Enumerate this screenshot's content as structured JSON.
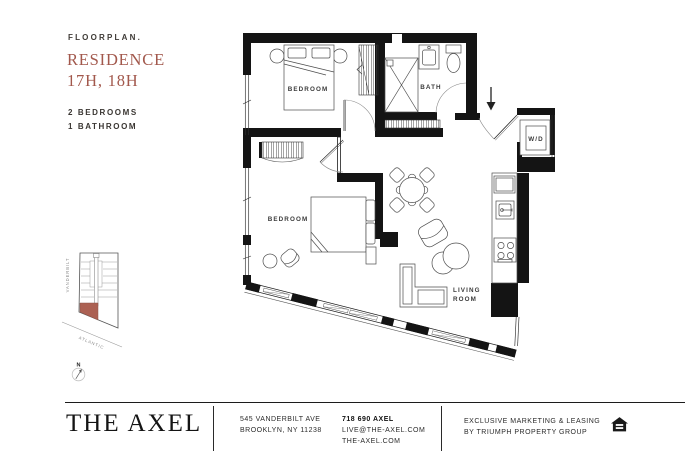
{
  "header": {
    "eyebrow": "FLOORPLAN.",
    "title_line1": "RESIDENCE",
    "title_line2": "17H, 18H",
    "spec_line1": "2 BEDROOMS",
    "spec_line2": "1 BATHROOM"
  },
  "colors": {
    "accent": "#A2584C",
    "wall": "#141414",
    "keyplan_highlight": "#AC6153"
  },
  "keyplan": {
    "street_left": "VANDERBILT",
    "street_bottom": "ATLANTIC",
    "compass_label": "N"
  },
  "floorplan": {
    "bedroom1_label": "BEDROOM",
    "bedroom2_label": "BEDROOM",
    "bath_label": "BATH",
    "wd_label": "W/D",
    "living_label_line1": "LIVING",
    "living_label_line2": "ROOM"
  },
  "footer": {
    "logo": "THE AXEL",
    "address_line1": "545 VANDERBILT AVE",
    "address_line2": "BROOKLYN, NY 11238",
    "phone": "718 690 AXEL",
    "email": "LIVE@THE-AXEL.COM",
    "website": "THE-AXEL.COM",
    "marketing_line1": "EXCLUSIVE MARKETING & LEASING",
    "marketing_line2": "BY TRIUMPH PROPERTY GROUP"
  }
}
